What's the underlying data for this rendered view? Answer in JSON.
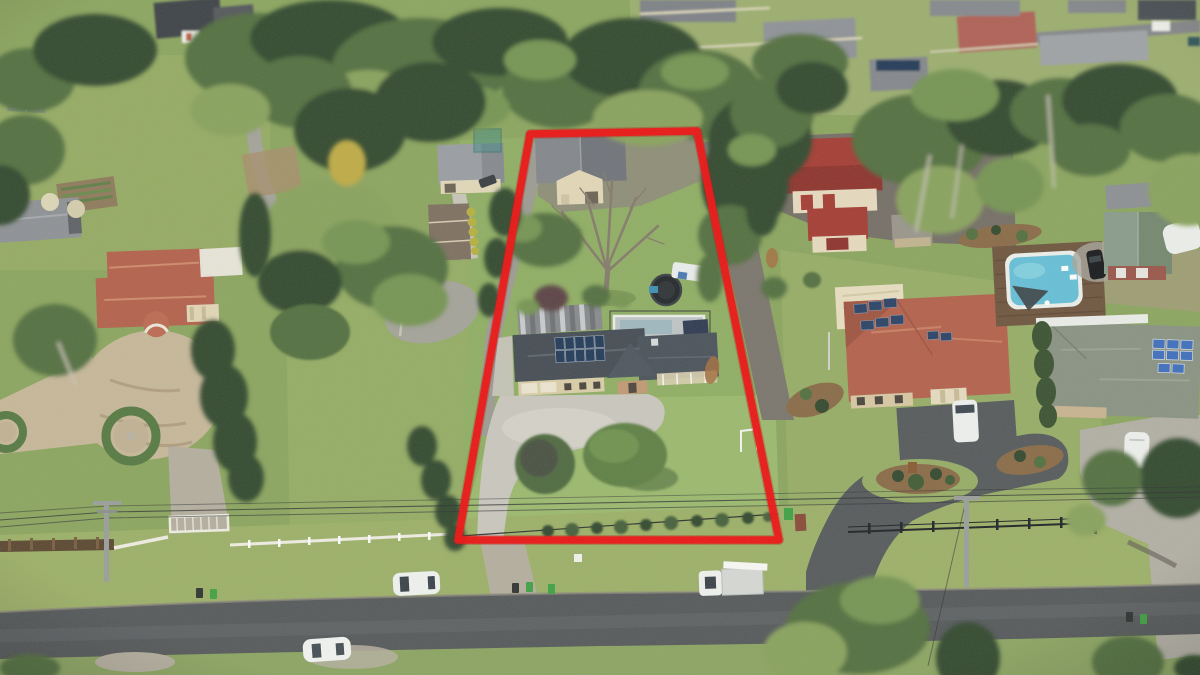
{
  "meta": {
    "image_type": "aerial-drone-photograph",
    "subject": "acreage property outlined with red boundary, surrounded by rural-residential homes, street in foreground",
    "visible_text": "none"
  },
  "boundary": {
    "color": "#ED1212",
    "shape": "trapezoid",
    "stroke_px": 8
  },
  "palette": {
    "grass": "#8CA65F",
    "paddock": "#96AC64",
    "lawn": "#9CBA6E",
    "verge": "#9DB168",
    "grass-s": "#8CA562",
    "tree-dark": "#33492E",
    "tree-mid": "#52703F",
    "tree-light": "#769552",
    "tree-olive": "#89A35D",
    "tree-yellow": "#C0AC45",
    "road": "#56595B",
    "road-light": "#6A6E70",
    "gravel": "#A5A49B",
    "gravel-dark": "#756F66",
    "gravel-warm": "#B5AF9F",
    "concrete": "#CBC8BF",
    "concrete-light": "#DAD7CD",
    "dirt": "#BFA98A",
    "sand": "#C8B899",
    "roof-dark": "#454C54",
    "roof-ridge": "#5D656D",
    "roof-gray": "#909499",
    "roof-red": "#A53C33",
    "terracotta": "#B4614C",
    "terracotta-light": "#C97F63",
    "roof-green": "#7F9180",
    "cream": "#E6DCBE",
    "wall-cream": "#DCCFA9",
    "brick": "#C19A74",
    "wall-red": "#9A574A",
    "solar": "#223A58",
    "solar-blue": "#3E6FBE",
    "pool": "#66C0D8",
    "deck": "#6F563F",
    "white": "#F3F3EE",
    "black": "#26282A",
    "bin-green": "#3FA244",
    "fence-white": "#F1EFE4",
    "fence-brown": "#5B4731",
    "trunk": "#C9C6B4",
    "branch": "#857B6B",
    "rust": "#A4703F",
    "boundary": "#ED1212"
  },
  "inventory": [
    "red-boundary-outline",
    "subject-house",
    "subject-solar-array",
    "carport",
    "barn-shed",
    "bare-deciduous-tree",
    "trampoline",
    "subject-pool",
    "concrete-driveway",
    "gravel-side-lane",
    "front-lawn-tree",
    "plum-tree",
    "hedge-row",
    "goal-posts",
    "left-house",
    "sand-forecourt",
    "circular-hedge-garden",
    "grey-shed",
    "water-tanks",
    "vegetable-garden",
    "green-shed",
    "middle-house",
    "machinery-shed",
    "teal-enclosure",
    "red-barn",
    "right-house",
    "right-solar-panels",
    "white-van",
    "flagpole",
    "pool-deck",
    "neighbour-pool",
    "shade-sail",
    "black-car",
    "green-roof-shed",
    "caravan",
    "far-right-house",
    "blue-solar-array",
    "rv-motorhome",
    "street-road",
    "white-suv",
    "white-sedan",
    "white-utility-truck",
    "wheelie-bins",
    "white-picket-fence",
    "front-gate",
    "timber-fence",
    "black-rail-fence",
    "power-pole",
    "power-lines",
    "suburb-houses",
    "eucalyptus-canopy"
  ]
}
